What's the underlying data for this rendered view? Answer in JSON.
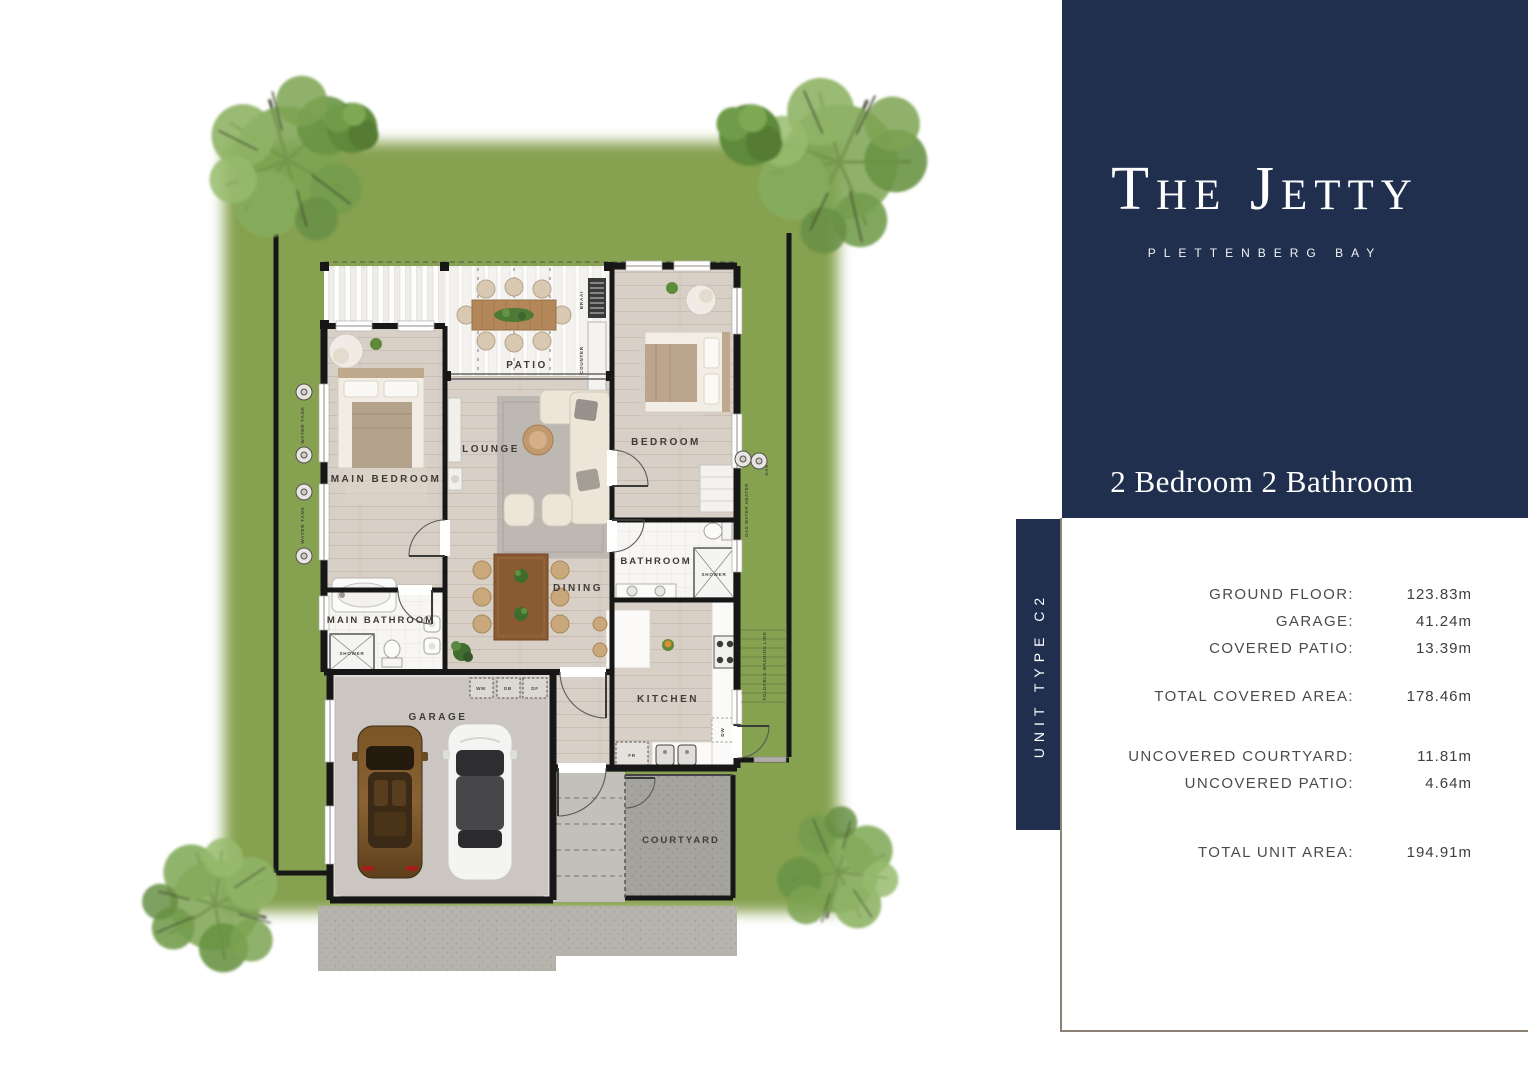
{
  "brand": {
    "name": "The Jetty",
    "location": "PLETTENBERG BAY"
  },
  "panel": {
    "heading": "2 Bedroom 2 Bathroom",
    "unit_type_label": "UNIT TYPE C2",
    "rows": [
      {
        "label": "GROUND FLOOR:",
        "value": "123.83m"
      },
      {
        "label": "GARAGE:",
        "value": "41.24m"
      },
      {
        "label": "COVERED PATIO:",
        "value": "13.39m"
      },
      {
        "label": "TOTAL COVERED AREA:",
        "value": "178.46m"
      },
      {
        "label": "UNCOVERED COURTYARD:",
        "value": "11.81m"
      },
      {
        "label": "UNCOVERED PATIO:",
        "value": "4.64m"
      },
      {
        "label": "TOTAL UNIT AREA:",
        "value": "194.91m"
      }
    ]
  },
  "plan": {
    "rooms": {
      "patio": "PATIO",
      "main_bedroom": "MAIN BEDROOM",
      "lounge": "LOUNGE",
      "bedroom": "BEDROOM",
      "main_bathroom": "MAIN BATHROOM",
      "dining": "DINING",
      "bathroom": "BATHROOM",
      "kitchen": "KITCHEN",
      "garage": "GARAGE",
      "courtyard": "COURTYARD"
    },
    "fixtures": {
      "braai": "BRAAI",
      "counter": "COUNTER",
      "shower_main": "SHOWER",
      "shower": "SHOWER",
      "wm": "WM",
      "db": "DB",
      "df": "DF",
      "fr": "FR",
      "dw": "DW",
      "water_tank_a": "WATER TANK",
      "water_tank_b": "WATER TANK",
      "gas": "GAS",
      "gas_water_heater": "GAS WATER HEATER",
      "washing_line": "FOLDABLE WASHING LINE"
    }
  },
  "colors": {
    "navy": "#1f2f4d",
    "frame_border": "#8b8275",
    "grass": "#86a150"
  }
}
